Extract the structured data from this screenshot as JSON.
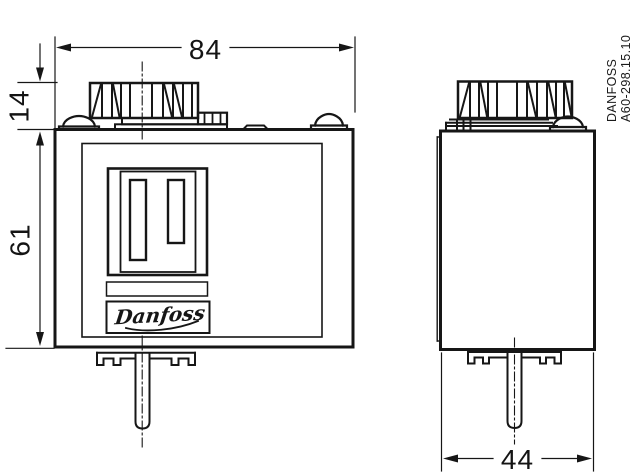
{
  "dimensions": {
    "overall_width_mm": "84",
    "knob_height_mm": "14",
    "body_height_mm": "61",
    "depth_mm": "44"
  },
  "labels": {
    "brand_vertical_line1": "DANFOSS",
    "brand_vertical_line2": "A60-298.15.10",
    "logo_script": "Danfoss"
  }
}
